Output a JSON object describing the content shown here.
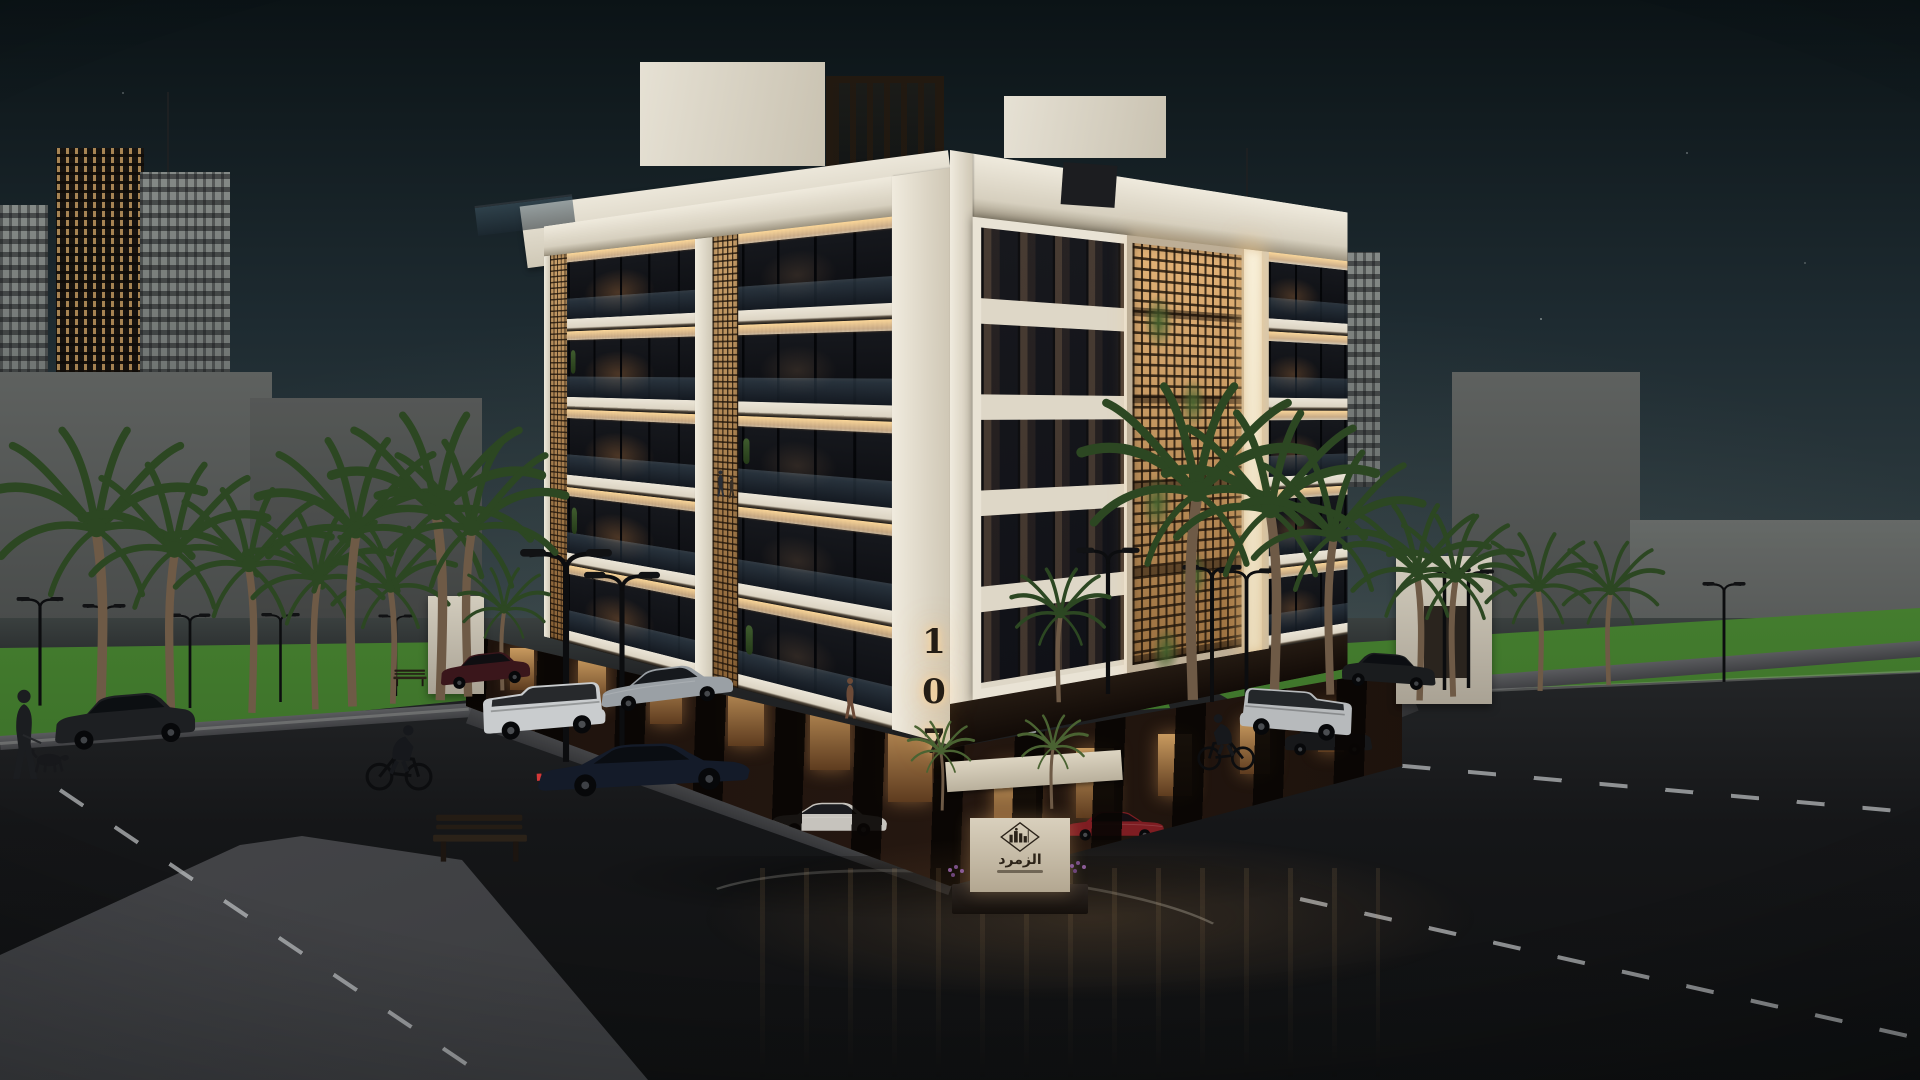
{
  "scene": {
    "description": "Dusk architectural rendering of a five-storey cream residential building with warm-lit mashrabiya screens, street palms, lamps, parked cars, cyclists and a pedestrian walking a dog",
    "time_of_day": "dusk",
    "building": {
      "number": "107",
      "floors_visible": 5
    },
    "entrance_sign": {
      "title": "الزمرد",
      "emblem": "city-skyline-in-diamond-outline"
    },
    "palette": {
      "sky_top": "#0b1316",
      "sky_mid": "#1e2b31",
      "sky_horizon": "#44504f",
      "facade_cream": "#d5ccba",
      "facade_shadow": "#b4aa96",
      "slab_white": "#ebe5d7",
      "warm_light": "#ffd694",
      "screen_warm": "#d9a766",
      "screen_frame": "#bdae96",
      "glass_dark": "#121419",
      "rail_glass": "#3a4c5c",
      "podium_dark": "#170f0a",
      "podium_warm": "#c89a5f",
      "grass": "#4c8a33",
      "grass_dark": "#2e5a21",
      "asphalt": "#18191c",
      "sidewalk": "#4e4f52",
      "curb": "#8e9194",
      "tower_gray": "#7d817f",
      "tower_lit": "#d8a967",
      "bg_block": "#565957",
      "white_wall": "#cfc9ba",
      "car_red": "#7e1d22",
      "number_dark": "#241d15",
      "sign_stone": "#d2c9b6",
      "glow_warm": "#f3c287"
    },
    "objects": {
      "background_towers": 5,
      "street_lamps": 13,
      "palm_trees": 19,
      "vehicles": 10,
      "people": 6,
      "benches": 2
    }
  }
}
